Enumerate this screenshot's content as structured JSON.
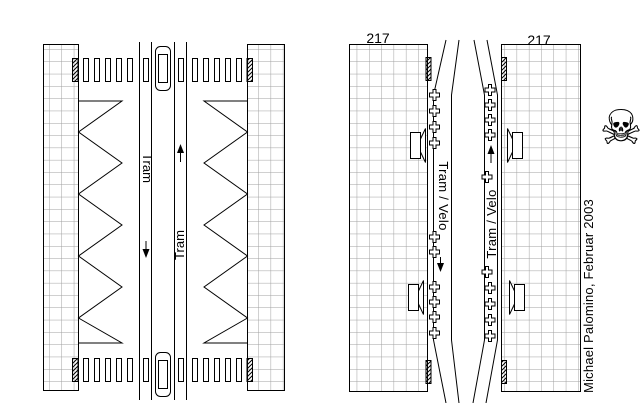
{
  "left_panel": {
    "south_lane_label": "Tram",
    "north_lane_label": "Tram"
  },
  "right_panel": {
    "left_street_number": "217",
    "right_street_number": "217",
    "south_lane_label": "Tram / Velo",
    "north_lane_label": "Tram / Velo"
  },
  "credit": "Michael Palomino, Februar 2003",
  "icons": {
    "skull_glyph": "☠",
    "skull_name": "skull-and-crossbones",
    "cross_marker_name": "grave-cross",
    "speaker_name": "loudspeaker"
  },
  "colors": {
    "ink": "#000000",
    "grid_line": "#a0a0a0",
    "background": "#ffffff"
  }
}
